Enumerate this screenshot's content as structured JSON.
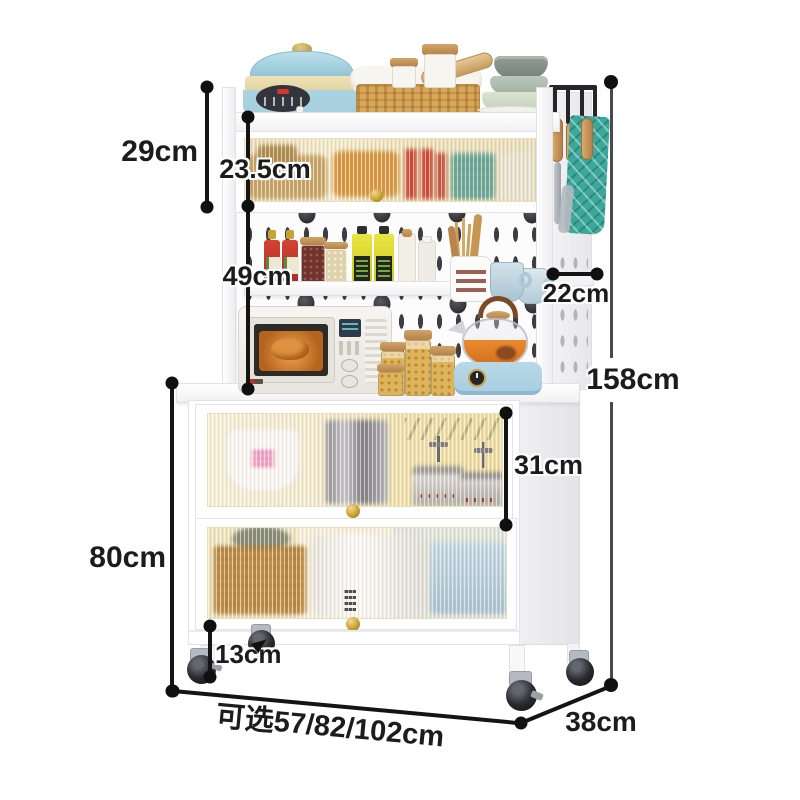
{
  "labels": {
    "hutch_height": "29cm",
    "top_cabinet_height": "23.5cm",
    "middle_section_height": "49cm",
    "shelf_depth": "22cm",
    "total_height": "158cm",
    "upper_cabinet_height": "31cm",
    "lower_section_height": "80cm",
    "ground_clearance": "13cm",
    "width_options": "可选57/82/102cm",
    "depth": "38cm"
  },
  "colors": {
    "dimension_line": "#141414",
    "label_text": "#1c1c1c",
    "cabinet_white": "#ffffff",
    "glass_amber": "#f0e2b4",
    "knob_gold": "#c9a233",
    "pot_blue": "#a5cedd",
    "warmer_blue": "#b9d8e8",
    "towel_teal": "#3ba89b",
    "basket_tan": "#d8a75a",
    "wheel_black": "#1f1f22"
  }
}
